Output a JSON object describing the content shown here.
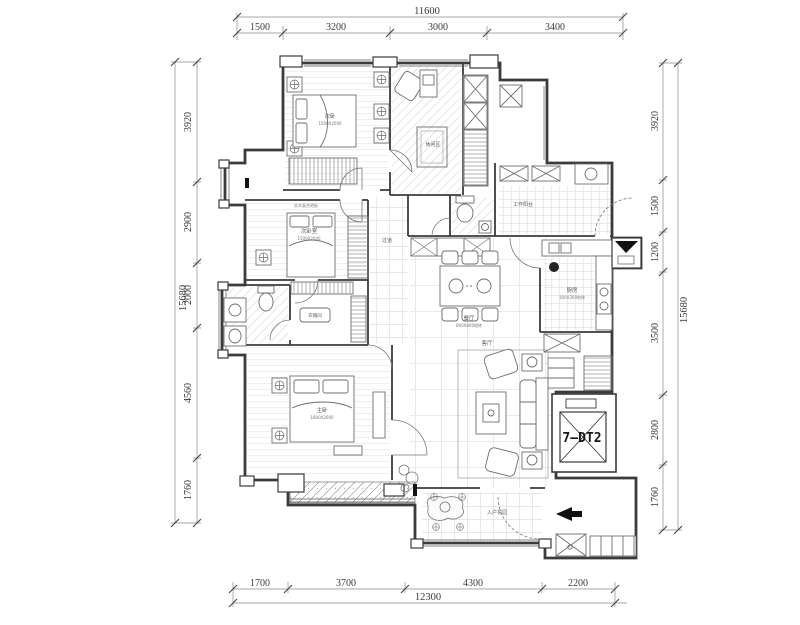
{
  "dims": {
    "top": {
      "total": "11600",
      "segments": [
        "1500",
        "3200",
        "3000",
        "3400"
      ]
    },
    "bottom": {
      "total": "12300",
      "segments": [
        "1700",
        "3700",
        "4300",
        "2200"
      ]
    },
    "left": {
      "total": "15680",
      "segments": [
        "3920",
        "2900",
        "2000",
        "4560",
        "1760"
      ]
    },
    "right": {
      "total": "15680",
      "segments": [
        "3920",
        "1500",
        "1200",
        "3500",
        "2800",
        "1760"
      ]
    }
  },
  "rooms": {
    "bedroom_top": {
      "name": "次卧",
      "size": "1500X2000"
    },
    "lounge": {
      "name": "休闲区"
    },
    "work_balcony": {
      "name": "工作阳台"
    },
    "kitchen": {
      "name": "厨房",
      "size": "300X300地砖"
    },
    "dining": {
      "name": "餐厅",
      "size": "800X800地砖"
    },
    "living": {
      "name": "客厅"
    },
    "corridor": {
      "name": "过道"
    },
    "bedroom_mid": {
      "name": "次卧室",
      "size": "1500X2000",
      "floor": "实木复合地板"
    },
    "closet": {
      "name": "衣帽间"
    },
    "master": {
      "name": "主卧",
      "size": "1800X2000"
    },
    "entry": {
      "name": "入户花园"
    }
  },
  "elevator": {
    "label": "7—DT2"
  },
  "colors": {
    "wall": "#3b3b3b",
    "furniture": "#6e6e6e",
    "dim_line": "#555555",
    "hatch": "#9a9a9a",
    "background": "#ffffff"
  }
}
